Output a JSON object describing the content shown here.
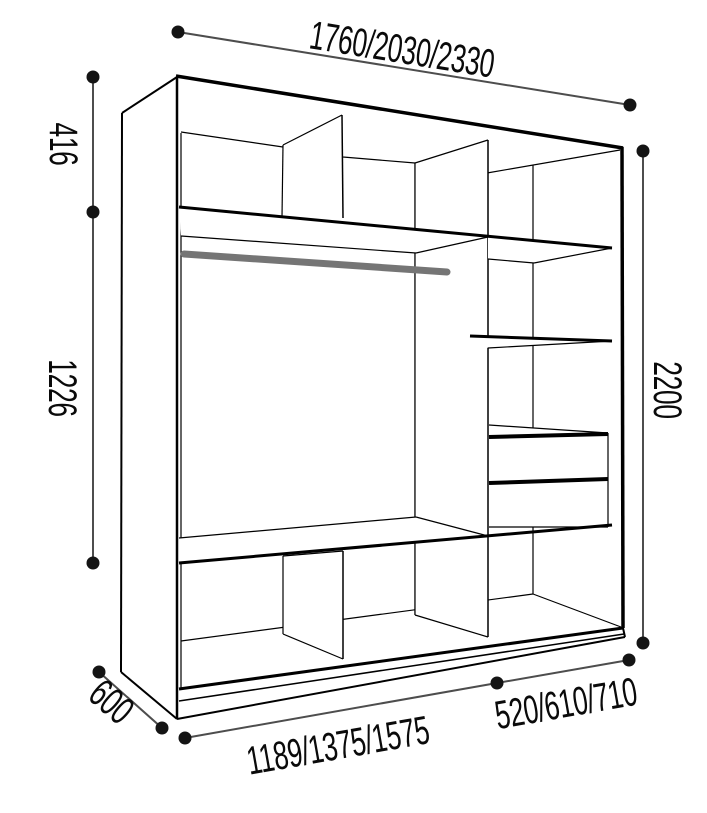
{
  "diagram": {
    "title": "wardrobe-dimensions-diagram",
    "dimensions": {
      "width_options": "1760/2030/2330",
      "height_total": "2200",
      "top_section_height": "416",
      "hanging_section_height": "1226",
      "depth": "600",
      "left_section_width_options": "1189/1375/1575",
      "right_section_width_options": "520/610/710"
    },
    "colors": {
      "structure_line": "#000000",
      "dimension_line": "#4d4d4d",
      "dimension_dot": "#141414",
      "hanging_rod": "#757575",
      "background": "#ffffff"
    }
  }
}
